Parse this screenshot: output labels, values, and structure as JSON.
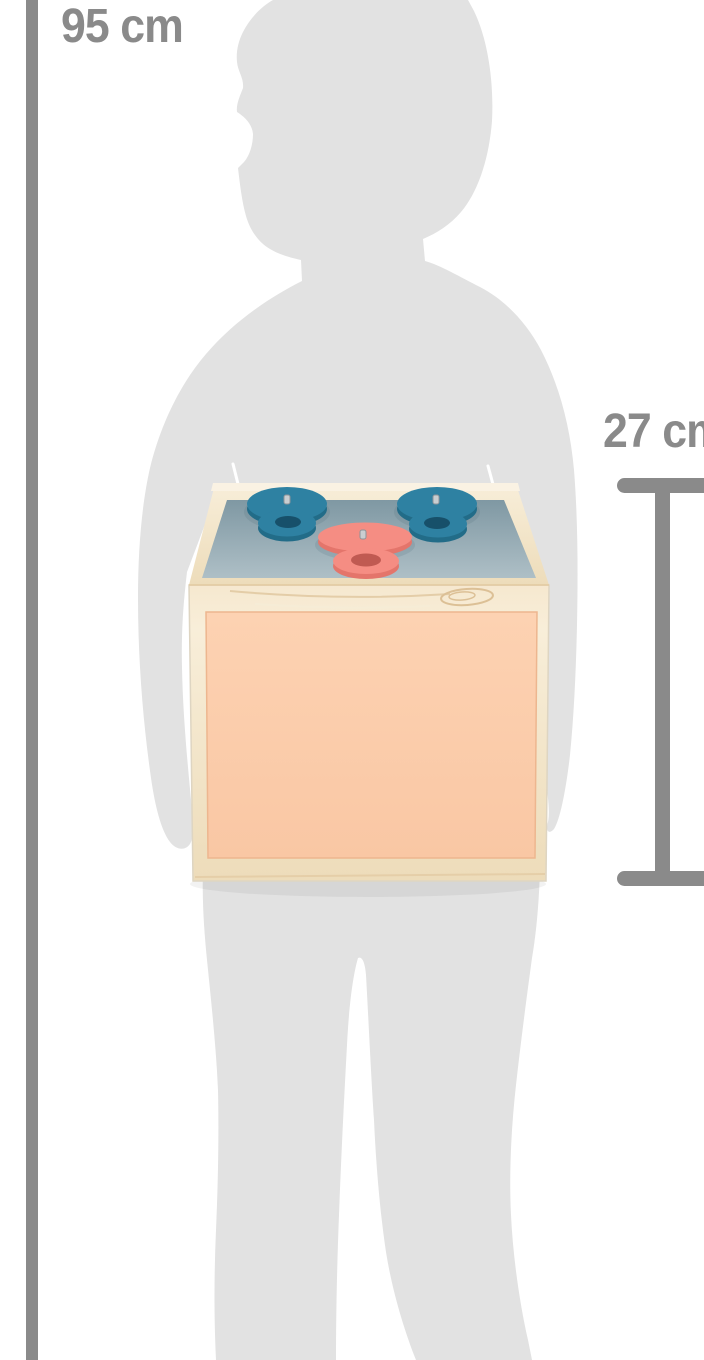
{
  "labels": {
    "child_height": "95 cm",
    "box_height": "27 cm"
  },
  "figure": {
    "kind": "child-silhouette",
    "holding": "wooden-sorting-box"
  },
  "product": {
    "top_pieces": [
      "blue-disc",
      "blue-ring",
      "blue-disc",
      "blue-ring",
      "coral-disc",
      "coral-ring"
    ]
  },
  "colors": {
    "bg": "#ffffff",
    "silhouette": "#e2e2e2",
    "measure": "#8a8a8a",
    "wood_light": "#f8eed9",
    "wood_dark": "#eddcba",
    "wood_edge": "#e2c9a0",
    "grain": "#dcc096",
    "panel_blue_dark": "#7f98a3",
    "panel_blue_light": "#aebfc6",
    "peach": "#fdd2b2",
    "peach_dark": "#f9c7a4",
    "peach_edge": "#edb68f",
    "disc_blue": "#2e81a2",
    "disc_blue_side": "#226c88",
    "hole_blue": "#17506a",
    "disc_coral": "#f58d83",
    "disc_coral_side": "#e4756b",
    "hole_coral": "#c05a52",
    "pin": "#c9ced1",
    "pin_edge": "#8d9499"
  }
}
